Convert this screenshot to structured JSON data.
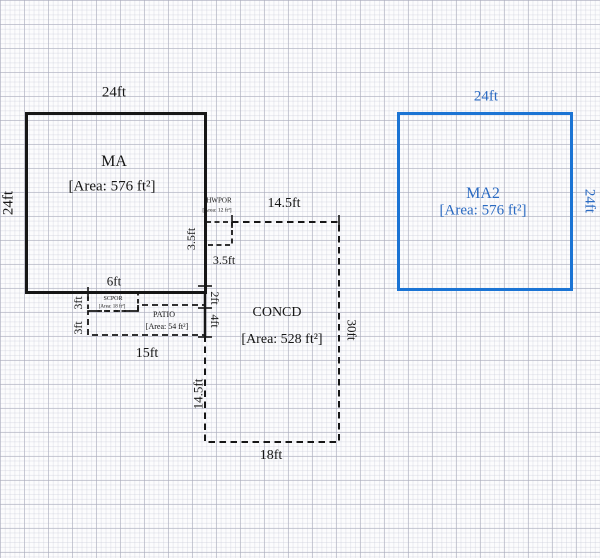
{
  "areas": {
    "ma": {
      "name": "MA",
      "area": "[Area: 576 ft²]"
    },
    "ma2": {
      "name": "MA2",
      "area": "[Area: 576 ft²]"
    },
    "concd": {
      "name": "CONCD",
      "area": "[Area: 528 ft²]"
    },
    "hwpor": {
      "name": "HWPOR",
      "area": "[Area: 12 ft²]"
    },
    "scpor": {
      "name": "SCPOR",
      "area": "[Area: 18 ft²]"
    },
    "patio": {
      "name": "PATIO",
      "area": "[Area: 54 ft²]"
    }
  },
  "dims": {
    "ma_top": "24ft",
    "ma_left": "24ft",
    "ma2_top": "24ft",
    "ma2_right": "24ft",
    "concd_top": "14.5ft",
    "concd_right": "30ft",
    "concd_bottom": "18ft",
    "concd_left": "14.5ft",
    "hwpor_left": "3.5ft",
    "hwpor_bottom": "3.5ft",
    "scpor_top": "6ft",
    "scpor_left": "3ft",
    "patio_left": "3ft",
    "patio_bottom": "15ft",
    "wall_2ft": "2ft",
    "wall_4ft": "4ft"
  },
  "colors": {
    "accent_blue": "#1b74d4",
    "ink": "#161616"
  }
}
